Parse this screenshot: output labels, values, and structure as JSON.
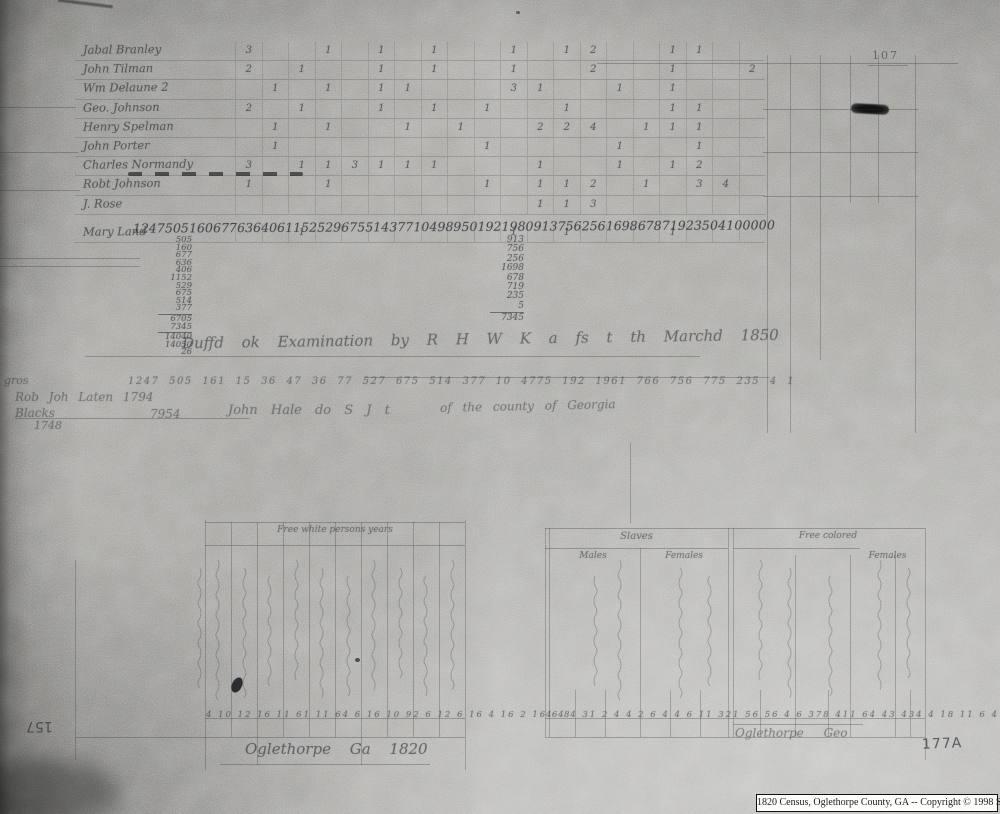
{
  "page": {
    "stamp_page_number": "107",
    "handwritten_page_label": "177A",
    "rotated_margin_number": "157",
    "caption": "1820 Census, Oglethorpe County, GA -- Copyright © 1998 S-K Publications"
  },
  "upper_table": {
    "rows": [
      {
        "name": "Jabal Branley",
        "cells": [
          "3",
          "",
          "",
          "1",
          "",
          "1",
          "",
          "1",
          "",
          "",
          "1",
          "",
          "1",
          "2",
          "",
          "",
          "1",
          "1",
          "",
          ""
        ]
      },
      {
        "name": "John Tilman",
        "cells": [
          "2",
          "",
          "1",
          "",
          "",
          "1",
          "",
          "1",
          "",
          "",
          "1",
          "",
          "",
          "2",
          "",
          "",
          "1",
          "",
          "",
          "2"
        ]
      },
      {
        "name": "Wm Delaune 2",
        "cells": [
          "",
          "1",
          "",
          "1",
          "",
          "1",
          "1",
          "",
          "",
          "",
          "3",
          "1",
          "",
          "",
          "1",
          "",
          "1",
          "",
          "",
          ""
        ]
      },
      {
        "name": "Geo. Johnson",
        "cells": [
          "2",
          "",
          "1",
          "",
          "",
          "1",
          "",
          "1",
          "",
          "1",
          "",
          "",
          "1",
          "",
          "",
          "",
          "1",
          "1",
          "",
          ""
        ]
      },
      {
        "name": "Henry Spelman",
        "cells": [
          "",
          "1",
          "",
          "1",
          "",
          "",
          "1",
          "",
          "1",
          "",
          "",
          "2",
          "2",
          "4",
          "",
          "1",
          "1",
          "1",
          "",
          ""
        ]
      },
      {
        "name": "John Porter",
        "cells": [
          "",
          "1",
          "",
          "",
          "",
          "",
          "",
          "",
          "",
          "1",
          "",
          "",
          "",
          "",
          "1",
          "",
          "",
          "1",
          "",
          ""
        ]
      },
      {
        "name": "Charles Normandy",
        "cells": [
          "3",
          "",
          "1",
          "1",
          "3",
          "1",
          "1",
          "1",
          "",
          "",
          "",
          "1",
          "",
          "",
          "1",
          "",
          "1",
          "2",
          "",
          ""
        ]
      },
      {
        "name": "Robt Johnson",
        "cells": [
          "1",
          "",
          "",
          "1",
          "",
          "",
          "",
          "",
          "",
          "1",
          "",
          "1",
          "1",
          "2",
          "",
          "1",
          "",
          "3",
          "4",
          ""
        ]
      },
      {
        "name": "J. Rose",
        "cells": [
          "",
          "",
          "",
          "",
          "",
          "",
          "",
          "",
          "",
          "",
          "",
          "1",
          "1",
          "3",
          "",
          "",
          "",
          "",
          "",
          ""
        ]
      },
      {
        "name": "Mary Land",
        "cells": [
          "",
          "",
          "1",
          "",
          "",
          "",
          "",
          "",
          "",
          "",
          "1",
          "",
          "1",
          "",
          "",
          "",
          "1",
          "",
          "",
          ""
        ]
      }
    ]
  },
  "totals_row": {
    "tokens": [
      "1247",
      "505",
      "160",
      "677",
      "636",
      "406",
      "1152",
      "529",
      "675",
      "514",
      "377",
      "10",
      "4989",
      "50",
      "192",
      "1980",
      "913",
      "756",
      "256",
      "1698",
      "678",
      "719",
      "235",
      "0",
      "4",
      "1",
      "0",
      "0",
      "0",
      "0",
      "0"
    ]
  },
  "left_sum": {
    "values": [
      "505",
      "160",
      "677",
      "636",
      "406",
      "1152",
      "529",
      "675",
      "514",
      "377"
    ],
    "subtotals": [
      "6705",
      "7345"
    ],
    "totals": [
      "14040",
      "14050",
      "26"
    ]
  },
  "middle_sum": {
    "values": [
      "913",
      "756",
      "256",
      "1698",
      "678",
      "719",
      "235",
      "5"
    ],
    "total": "7345"
  },
  "examination_line": "Duffd ok Examination by R H W K a fs t th Marchd 1850",
  "second_totals_row": "1247 505 161 15 36 47 36 77 527 675 514 377 10 4775 192 1961 766 756 775 235 4 1",
  "margin_notes": {
    "word_left": "gros",
    "line1": "Rob Joh Laten 1794",
    "line2a": "Blacks",
    "line2b": "7954",
    "line2c": "John Hale do S J t",
    "line2d": "of the county of Georgia",
    "line3": "1748"
  },
  "lower_table": {
    "header_left": "Free white persons     years",
    "slaves_header": "Slaves",
    "slaves_males": "Males",
    "slaves_females": "Females",
    "colored_header": "Free colored",
    "colored_sub": "Females",
    "columns_note": "faint vertical handwriting (illegible)",
    "numbers_left": "4 10 12 16 11 61 11 64 6 16 10 92 6 12 6 16 4 16 2 16 6 8",
    "numbers_right": "4 4 4 31 2 4 4 2 6 4 4 6 11 321 56 56 4 6 378 411 64 43 434 4 18 11 6 4 6 15 4",
    "script_left": "Oglethorpe Ga 1820",
    "script_right": "Oglethorpe   Geo"
  }
}
